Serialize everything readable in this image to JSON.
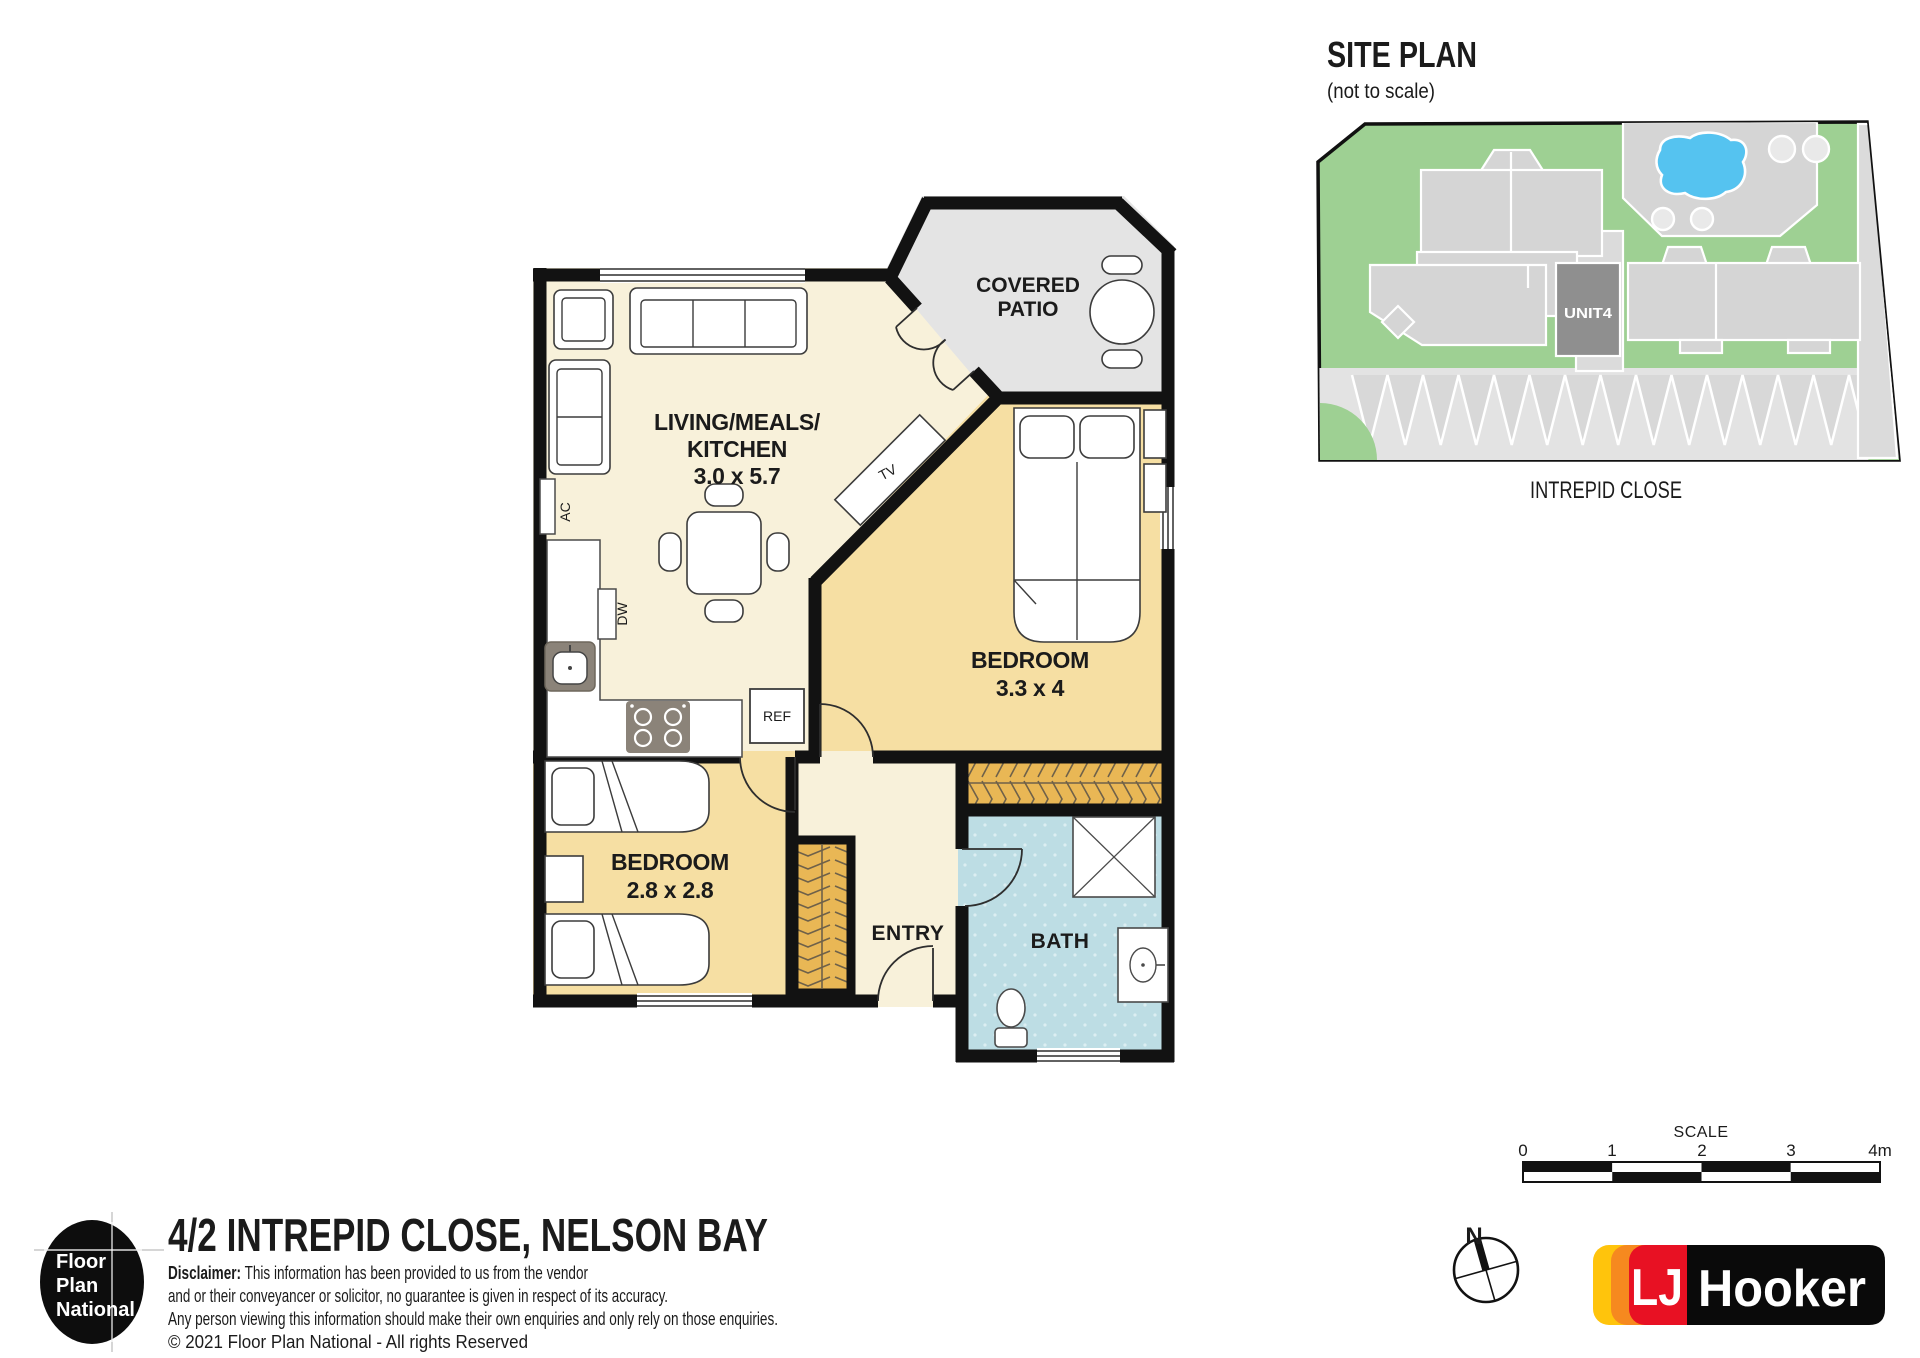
{
  "site": {
    "title": "SITE PLAN",
    "subtitle": "(not to scale)",
    "unit": "UNIT4",
    "street": "INTREPID CLOSE"
  },
  "fp": {
    "living": {
      "line1": "LIVING/MEALS/",
      "line2": "KITCHEN",
      "dims": "3.0 x 5.7"
    },
    "patio": {
      "line1": "COVERED",
      "line2": "PATIO"
    },
    "bed1": {
      "name": "BEDROOM",
      "dims": "3.3 x 4"
    },
    "bed2": {
      "name": "BEDROOM",
      "dims": "2.8 x 2.8"
    },
    "entry": "ENTRY",
    "bath": "BATH",
    "fix": {
      "ac": "AC",
      "dw": "DW",
      "ref": "REF",
      "tv": "TV"
    }
  },
  "scale": {
    "title": "SCALE",
    "ticks": [
      "0",
      "1",
      "2",
      "3",
      "4m"
    ]
  },
  "compass": {
    "label": "N"
  },
  "brand": {
    "fpn": [
      "Floor",
      "Plan",
      "National"
    ],
    "lj": "LJ",
    "hooker": "Hooker"
  },
  "footer": {
    "address": "4/2 INTREPID CLOSE, NELSON BAY",
    "d_bold": "Disclaimer:",
    "d_rest": " This information has been provided to us from the vendor",
    "line2": "and or their conveyancer or solicitor, no guarantee is given in respect of its accuracy.",
    "line3": "Any person viewing this information should make their own enquiries and only rely on those enquiries.",
    "line4": "© 2021 Floor Plan National - All rights Reserved"
  },
  "colors": {
    "walls": "#121212",
    "living_floor": "#f8f1da",
    "bedroom_floor": "#f6dfa3",
    "robe": "#e9b755",
    "bath_floor": "#bddde4",
    "patio_floor": "#e4e4e4",
    "site_green": "#9ed093",
    "site_building": "#d5d5d5",
    "unit_highlight": "#8f8f8f",
    "pool_blue": "#55c3f0",
    "lj_yellow": "#ffc40c",
    "lj_orange": "#f6891f",
    "lj_red": "#e81123",
    "lj_black": "#0a0a0a"
  }
}
